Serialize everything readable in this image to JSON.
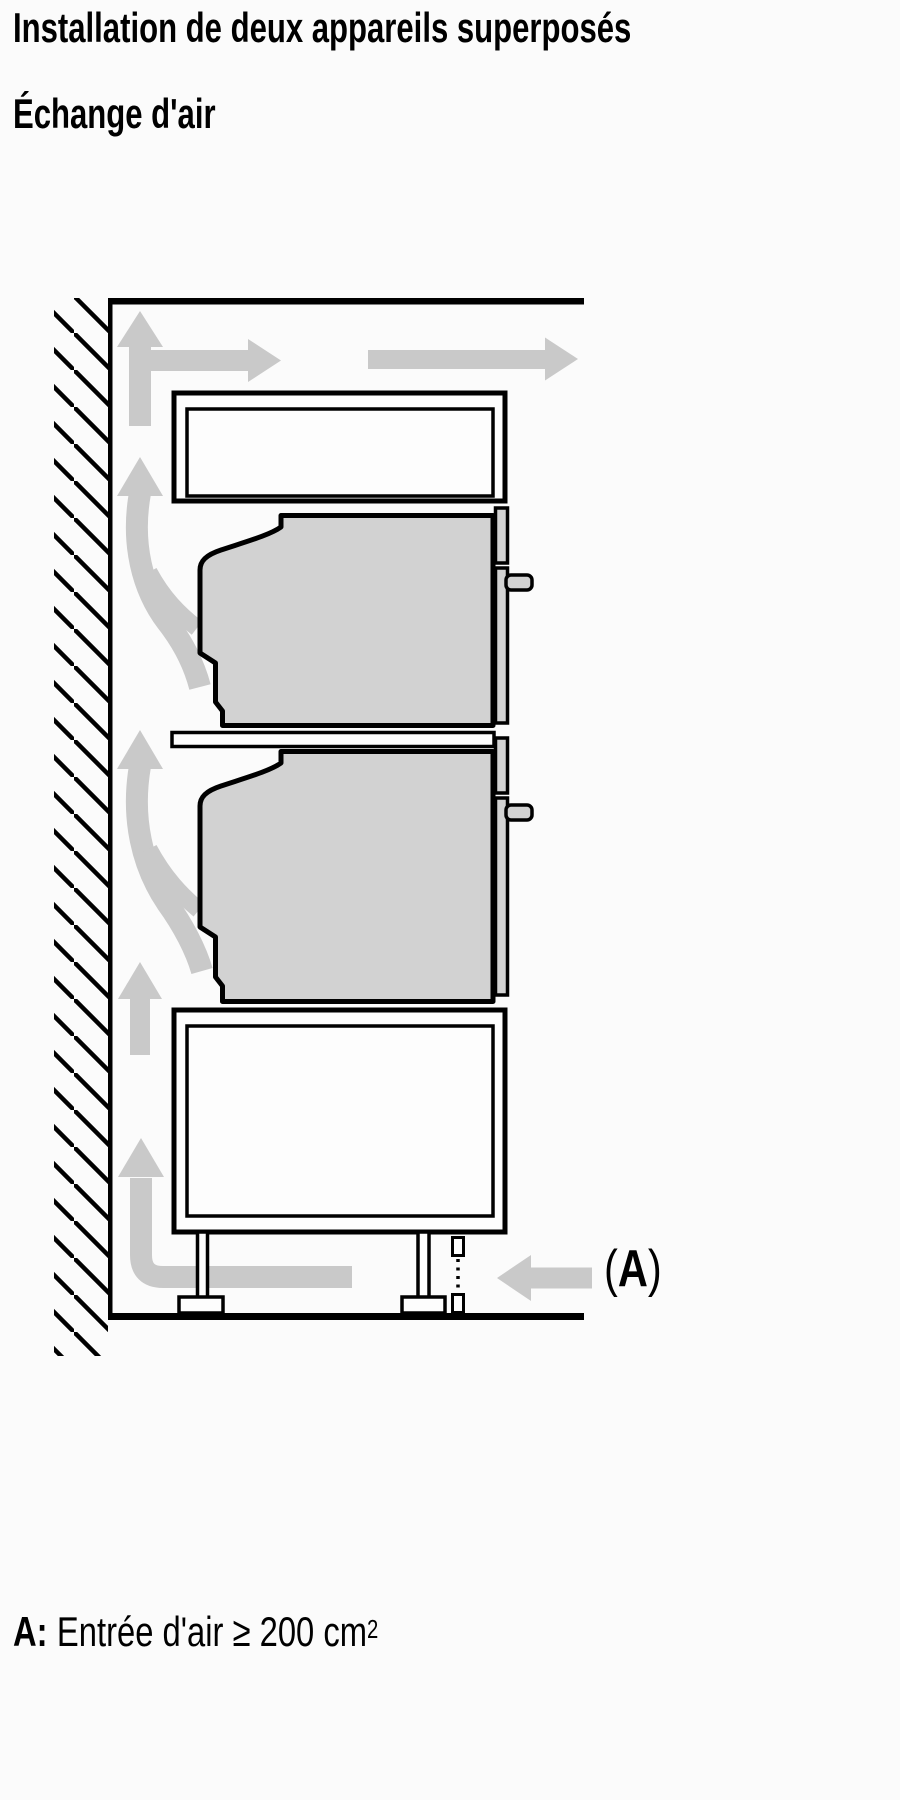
{
  "page": {
    "title": "Installation de deux appareils superposés",
    "subtitle": "Échange d'air"
  },
  "caption": {
    "prefix": "A:",
    "text": "Entrée d'air ≥ 200 cm",
    "superscript": "2"
  },
  "diagram_label": {
    "open": "(",
    "letter": "A",
    "close": ")"
  },
  "colors": {
    "outline": "#000000",
    "appliance_fill": "#d2d2d2",
    "arrow_gray": "#c9c9c9",
    "background": "#fbfbfb",
    "panel_fill": "#fdfdfd"
  }
}
